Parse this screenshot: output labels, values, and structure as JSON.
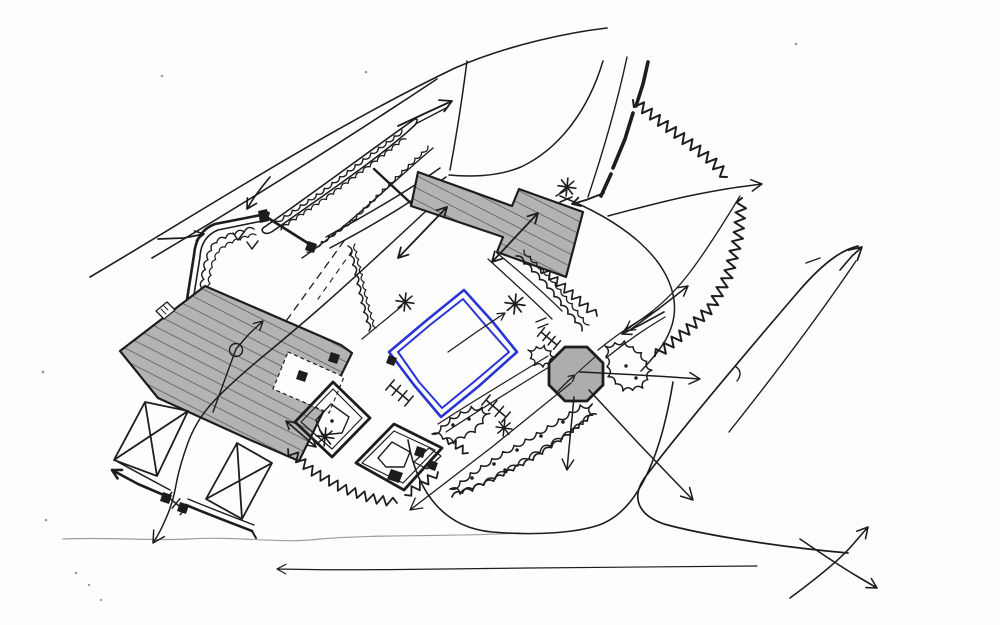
{
  "description": "Hand-drawn felt-tip concept sketch of a country-house and garden masterplan site plan: existing buildings hatched grey, a proposed square lawn court outlined in blue, an octagonal gazebo, tree belts, hedges, walled garden courts, crossed parterres and circulation and view arrows. No legible text appears in the drawing.",
  "visible_text": [],
  "colors": {
    "paper": "#fdfdfc",
    "ink": "#1d1d1d",
    "ink_faint": "#9d9d99",
    "building_fill": "#b3b3b3",
    "hatch_line": "#565656",
    "accent_blue": "#2a35d6",
    "octagon_fill": "#adadad"
  },
  "symbols": {
    "hatched-polygon": "existing building",
    "blue-double-square": "proposed lawn court",
    "octagon": "gazebo pavilion",
    "asterisk-star": "specimen tree",
    "crossed-square": "parterre court",
    "scalloped-line": "hedge / tree belt",
    "zigzag-line": "shrub edging",
    "arrow": "view / circulation"
  }
}
